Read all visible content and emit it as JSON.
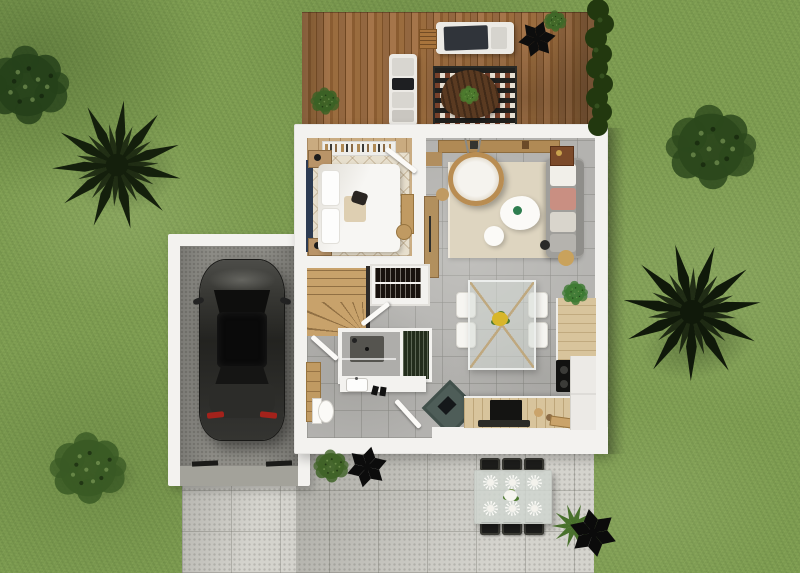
{
  "scene": {
    "label": "Top-down 3D render of a single-family house with garden",
    "regions": {
      "lawn": {
        "label": "Grass lawn"
      },
      "deck": {
        "label": "Wooden deck terrace"
      },
      "house": {
        "label": "House ground floor"
      },
      "garage": {
        "label": "Garage"
      },
      "patio": {
        "label": "Concrete patio and driveway"
      }
    }
  },
  "rooms": {
    "bedroom": {
      "label": "Bedroom"
    },
    "living_room": {
      "label": "Living room"
    },
    "kitchen": {
      "label": "Kitchen"
    },
    "dining_area": {
      "label": "Dining area"
    },
    "bathroom": {
      "label": "Shower room"
    },
    "wc": {
      "label": "Toilet"
    },
    "hallway": {
      "label": "Hallway"
    },
    "stairs": {
      "label": "Winder staircase"
    },
    "wardrobe": {
      "label": "Wardrobe"
    },
    "entry": {
      "label": "Entry"
    }
  },
  "furniture": {
    "bed": {
      "label": "Double bed"
    },
    "bedroom_shelf": {
      "label": "Clothes rack"
    },
    "nightstand": {
      "label": "Nightstand"
    },
    "living_sofa": {
      "label": "Sofa with chaise"
    },
    "hanging_chair": {
      "label": "Hanging rattan chair"
    },
    "coffee_table": {
      "label": "Coffee table"
    },
    "living_rug": {
      "label": "Cream area rug"
    },
    "tv_console": {
      "label": "Wall console"
    },
    "dining_table": {
      "label": "Glass dining table"
    },
    "dining_chair": {
      "label": "Dining chair"
    },
    "kitchen_counter": {
      "label": "Kitchen counter with TV"
    },
    "cooktop": {
      "label": "Cooktop"
    },
    "fridge": {
      "label": "Refrigerator"
    },
    "shower": {
      "label": "Walk-in shower"
    },
    "vanity": {
      "label": "Bathroom vanity"
    },
    "toilet": {
      "label": "Toilet"
    },
    "wardrobe_unit": {
      "label": "Wardrobe unit"
    },
    "entry_mat": {
      "label": "Entry doormat"
    },
    "car": {
      "label": "Parked car"
    },
    "outdoor_sofa": {
      "label": "Outdoor sofa"
    },
    "outdoor_rug": {
      "label": "Patterned outdoor rug"
    },
    "deck_table": {
      "label": "Deck coffee table"
    },
    "patio_table": {
      "label": "Outdoor dining table"
    },
    "patio_chair": {
      "label": "Outdoor dining chair"
    },
    "place_setting": {
      "label": "Place setting"
    }
  },
  "vegetation": {
    "palm_left": {
      "label": "Palm tree"
    },
    "palm_right": {
      "label": "Palm tree"
    },
    "bush_top_left": {
      "label": "Shrub"
    },
    "bush_top_right": {
      "label": "Round shrub"
    },
    "bush_bottom_left": {
      "label": "Round shrub"
    },
    "hedge_right": {
      "label": "Hedge strip"
    },
    "patio_plants": {
      "label": "Potted plants"
    },
    "deck_plants": {
      "label": "Potted deck plants"
    },
    "kitchen_plant": {
      "label": "Houseplant"
    }
  },
  "palette": {
    "grass": "#7f9e52",
    "grass_dark": "#5c7a3c",
    "deck_wood": "#96683a",
    "wall_white": "#f3f2ef",
    "tile_gray": "#b3b2af",
    "bedroom_wood": "#c9ab80",
    "rug_cream": "#ded5c0",
    "stairs_wood": "#c8a26b",
    "counter_wood": "#d8c49c",
    "concrete_garage": "#8f8e88",
    "paver": "#d4d3cd",
    "car_body": "#2e2e2b",
    "taillight_red": "#a4221b",
    "mat_teal": "#4e5d58",
    "cushion_pink": "#c98f82",
    "accent_navy": "#2c3b52",
    "foliage_dark": "#16220e",
    "foliage_mid": "#2c481c",
    "foliage_light": "#4e7a2f"
  }
}
